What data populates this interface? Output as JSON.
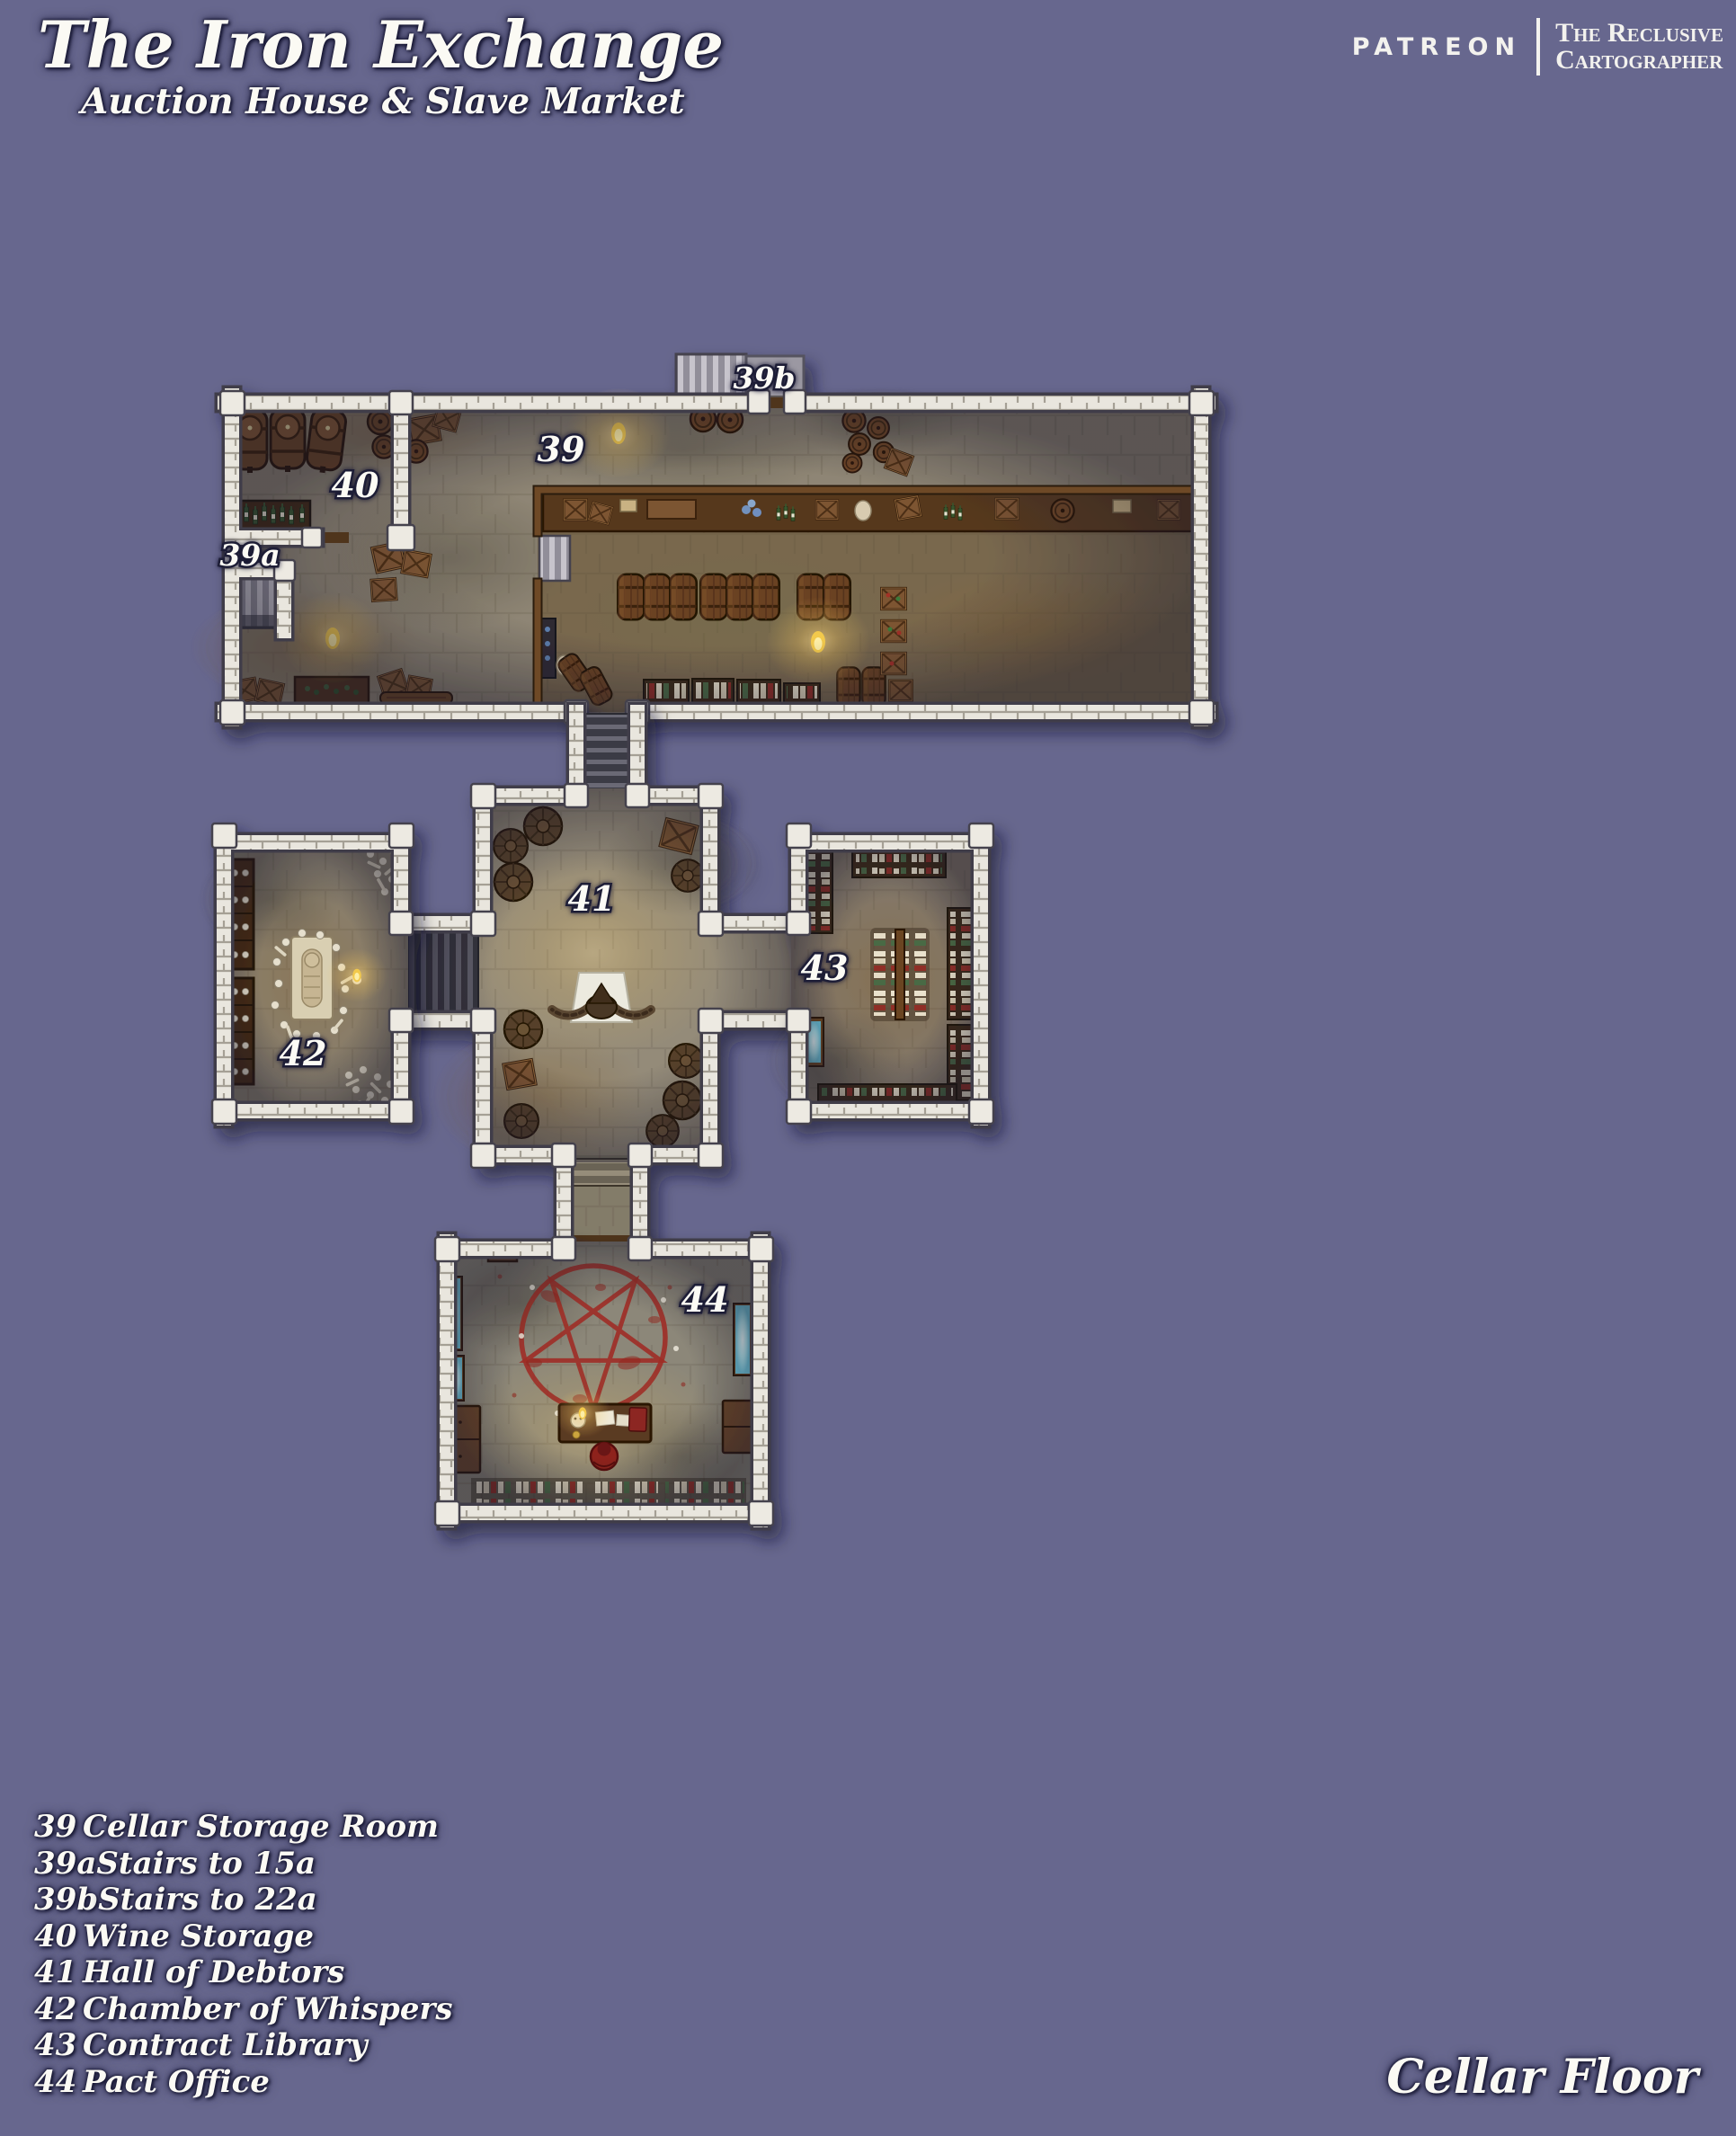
{
  "header": {
    "title": "The Iron Exchange",
    "subtitle": "Auction House & Slave Market",
    "brand": "PATREON",
    "credit_line1": "The Reclusive",
    "credit_line2": "Cartographer"
  },
  "footer": {
    "floor_label": "Cellar Floor"
  },
  "legend": {
    "items": [
      {
        "num": "39",
        "label": "Cellar Storage Room"
      },
      {
        "num": "39a",
        "label": "Stairs to 15a"
      },
      {
        "num": "39b",
        "label": "Stairs to 22a"
      },
      {
        "num": "40",
        "label": "Wine Storage"
      },
      {
        "num": "41",
        "label": "Hall of Debtors"
      },
      {
        "num": "42",
        "label": "Chamber of Whispers"
      },
      {
        "num": "43",
        "label": "Contract Library"
      },
      {
        "num": "44",
        "label": "Pact Office"
      }
    ]
  },
  "map": {
    "labels": [
      {
        "text": "39b"
      },
      {
        "text": "39"
      },
      {
        "text": "40"
      },
      {
        "text": "39a"
      },
      {
        "text": "41"
      },
      {
        "text": "42"
      },
      {
        "text": "43"
      },
      {
        "text": "44"
      }
    ],
    "colors": {
      "background": "#67678e",
      "wall": "#e9e6de",
      "stone_floor": "#8e8574",
      "wood": "#6e4a27",
      "blood_red": "#9e2d26",
      "scry_cyan": "#aee9f2",
      "flame": "#ffd986"
    }
  }
}
